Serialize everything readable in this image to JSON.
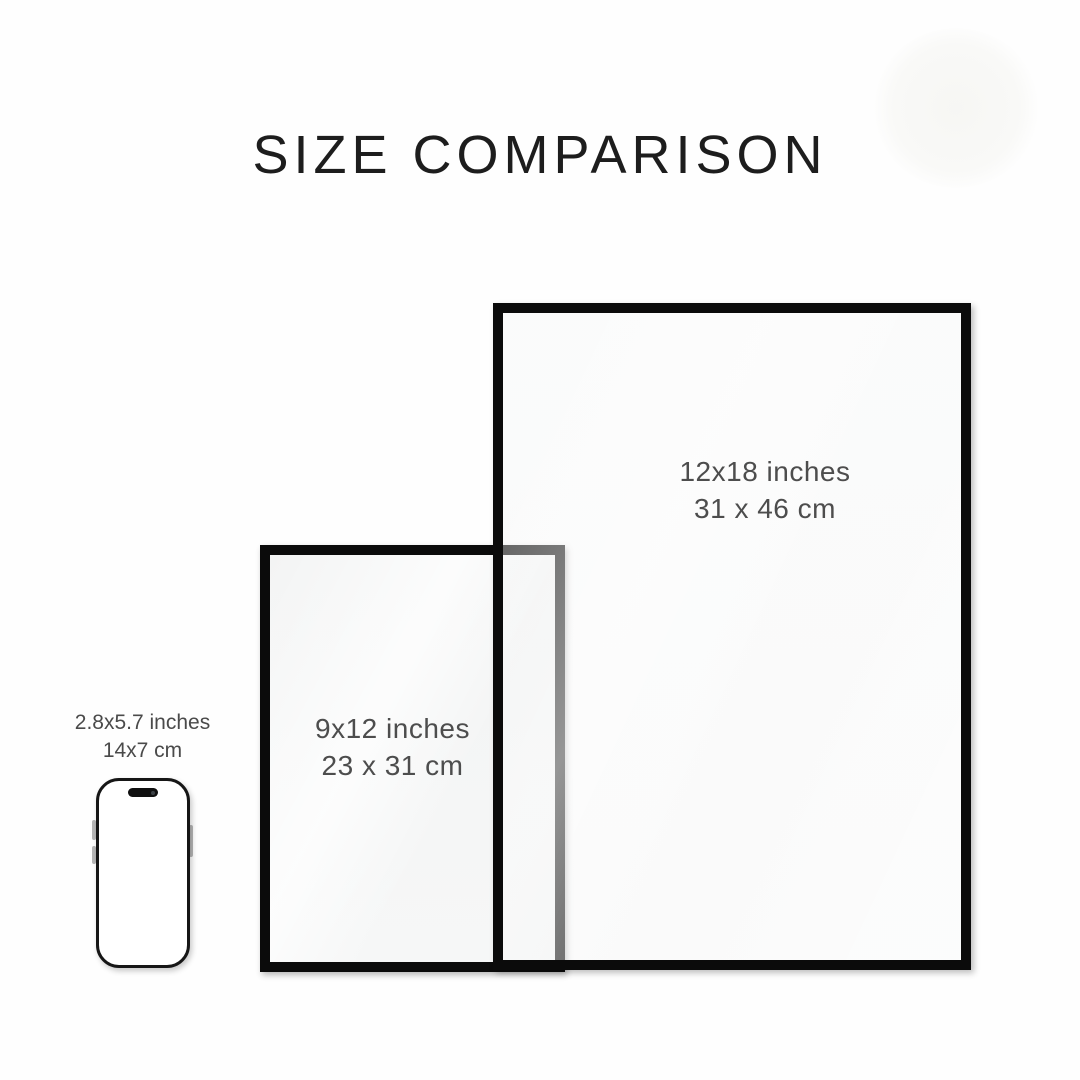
{
  "title": "SIZE COMPARISON",
  "colors": {
    "background": "#fefefe",
    "title_text": "#1d1d1d",
    "label_text": "#4d4d4d",
    "frame_border": "#0b0b0b",
    "paper": "#f5f6f6",
    "phone_frame": "#161616",
    "phone_screen": "#ffffff"
  },
  "items": [
    {
      "name": "poster-12x18",
      "size_in": "12x18 inches",
      "size_cm": "31 x 46 cm"
    },
    {
      "name": "poster-9x12",
      "size_in": "9x12 inches",
      "size_cm": "23 x 31 cm"
    },
    {
      "name": "phone",
      "size_in": "2.8x5.7 inches",
      "size_cm": "14x7 cm"
    }
  ]
}
